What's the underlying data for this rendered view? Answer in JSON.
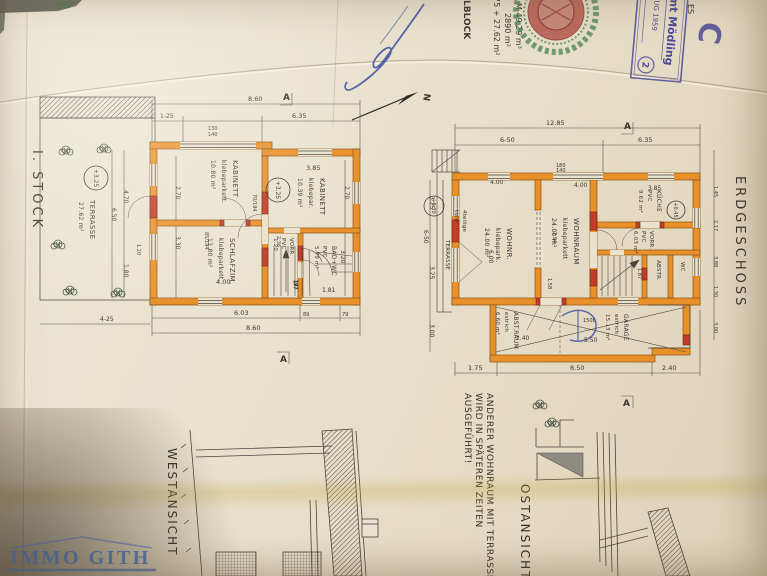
{
  "palette": {
    "wall_orange": "#e8912a",
    "wall_red": "#c23d28",
    "ink": "#3a352e",
    "line": "#4a443c",
    "stamp_blue": "#4b4a97",
    "pen_blue": "#3b4fa0",
    "watermark_blue": "#4a67a0"
  },
  "header": {
    "edge_text": "ES",
    "block_text": "LBLOCK",
    "area_lines": [
      "M 49.29 m³",
      "2890 m²",
      "75 + 27.62 m²"
    ],
    "stamp": {
      "office": "Amt Mödling",
      "date": "AUG 1959",
      "ref": "Bml.",
      "number": "2"
    },
    "letter_mark": "C",
    "north_label": "N"
  },
  "left_plan": {
    "title": "I. STOCK",
    "section_mark": "A",
    "level_terrace": "+3.25",
    "level_floor": "+3.25",
    "terrace": {
      "name": "TERRASSE",
      "area": "27.62 m²"
    },
    "rooms": {
      "kabinett1": {
        "name": "KABINETT",
        "floor": "klebeparkett.",
        "area": "10.80 m²"
      },
      "kabinett2": {
        "name": "KABINETT",
        "floor": "klebepar.",
        "area": "10.39 m²"
      },
      "schlafzimmer": {
        "name": "SCHLAFZIM.",
        "floor": "klebeparkett.",
        "area": "12.80 m²"
      },
      "vorraum": {
        "name": "VORR.",
        "floor": "PVC",
        "area": "1.20"
      },
      "bad": {
        "name": "BAD+WC",
        "floor": "PVC",
        "area": "5.79 m²"
      }
    },
    "stair_label": "197",
    "dims": {
      "top_total": "8.60",
      "top_left": "1-25",
      "top_right": "6.35",
      "win1": "130",
      "win2": "140",
      "left_a": "2.70",
      "left_b": "3.30",
      "left_c": "4.70",
      "left_d": "6.50",
      "left_e": "1.80",
      "left_f": "1.20",
      "right_a": "2.70",
      "right_b": "3.20",
      "bottom_a": "6.03",
      "bottom_total": "8.60",
      "bottom_b": "89",
      "bottom_c": "79",
      "bottom_d": "4-25",
      "schlaf_w": "4.00",
      "kab2_w": "3.85",
      "door1": "70/194",
      "door2": "85/194",
      "vorr_d": "2.36",
      "bad_d": "1.81"
    }
  },
  "right_plan": {
    "title": "ERDGESCHOSS",
    "section_mark": "A",
    "level_terrace": "+0.30",
    "level_kitchen": "+0.45",
    "terrace_label": "TERRASSE",
    "door_note_1": "4teilige",
    "door_note_2": "türe",
    "pen_note": "1500",
    "rooms": {
      "wohnr": {
        "name": "WOHNR.",
        "floor": "klebepark.",
        "area": "24.00 m²"
      },
      "wohnraum": {
        "name": "WOHNRAUM",
        "floor": "klebeparkett",
        "area": "24.00 m²"
      },
      "kueche": {
        "name": "KÜCHE",
        "floor": "PVC",
        "area": "9.62 m²"
      },
      "vorraum": {
        "name": "VORR.",
        "floor": "PVC",
        "area": "6.03 m²"
      },
      "abstellraum": {
        "name": "ABST.RAUM",
        "floor": "estrich",
        "area": "6.60 m²"
      },
      "garage": {
        "name": "GARAGE",
        "floor": "estrich",
        "area": "15.13 m²"
      },
      "abstr": "ABSTR.",
      "wc": "WC"
    },
    "dims": {
      "top_total": "12.85",
      "top_left": "6-50",
      "top_right": "6.35",
      "w1": "4.00",
      "w2": "4.00",
      "win1": "180",
      "win2": "140",
      "kueche_w": "3.85",
      "left_a": "3.25",
      "left_b": "6-50",
      "left_c": "3.25",
      "left_d": "3.00",
      "right_a": "1.45",
      "right_b": "2.17",
      "right_c": "3.88",
      "right_d": "1.30",
      "right_e": "3.00",
      "bottom_a": "1.75",
      "bottom_b": "8.50",
      "bottom_c": "2.40",
      "wohn_d": "2.94",
      "wohn_w": "6.00",
      "mid": "1.58",
      "garage_w": "5.50",
      "abst_w": "2.40",
      "stair": "1.87"
    }
  },
  "elevations": {
    "west_label": "WESTANSICHT",
    "east_label": "OSTANSICHT",
    "note_lines": [
      "ANDERER WOHNRAUM MIT TERRASSE",
      "WIRD IN SPÄTEREN ZEITEN",
      "AUSGEFÜHRT!"
    ]
  },
  "watermark": "IMMO GITH"
}
